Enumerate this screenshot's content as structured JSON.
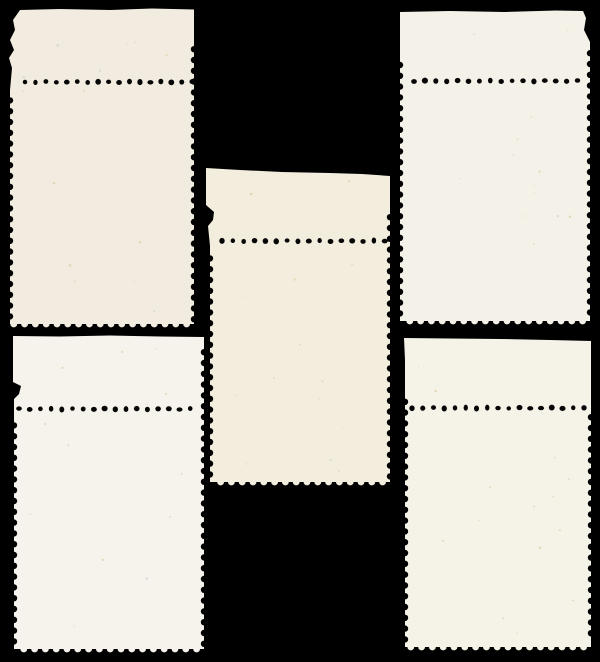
{
  "scene": {
    "description": "Scan of five mint postage stamps shown from the back, each with a blank top selvage tab, arranged on a black background",
    "width": 600,
    "height": 662,
    "background_color": "#000000"
  },
  "perforation": {
    "side_notch_radius": 3.2,
    "notch_period": 10.8,
    "tooth_radius": 3.4,
    "tooth_period": 10.8,
    "dot_base_radius": 2.6,
    "dot_color": "#060606"
  },
  "speck_colors": [
    "rgba(190,160,90,0.35)",
    "rgba(150,150,150,0.22)",
    "rgba(205,175,110,0.30)"
  ],
  "stamps": [
    {
      "name": "stamp-top-left",
      "color": "#f1ecdf",
      "left": 10,
      "right": 194,
      "bottom_y": 324,
      "right_perf_start": 46,
      "left_perf_start": 90,
      "top_edge_points": [
        [
          20,
          10
        ],
        [
          60,
          9
        ],
        [
          110,
          10
        ],
        [
          152,
          8.5
        ],
        [
          194,
          9.5
        ]
      ],
      "left_edge_points": [
        [
          20,
          10
        ],
        [
          13,
          20
        ],
        [
          15,
          30
        ],
        [
          10,
          40
        ],
        [
          14,
          50
        ],
        [
          9,
          58
        ],
        [
          12,
          68
        ],
        [
          10,
          90
        ]
      ],
      "dots": {
        "y": 82,
        "x1": 25,
        "spacing": 10.45,
        "count": 17
      }
    },
    {
      "name": "stamp-top-right",
      "color": "#f4f1e8",
      "left": 400,
      "right": 590,
      "bottom_y": 321,
      "right_perf_start": 50,
      "left_perf_start": 56,
      "top_edge_points": [
        [
          400,
          12
        ],
        [
          450,
          11
        ],
        [
          505,
          12
        ],
        [
          556,
          10.5
        ],
        [
          583,
          11
        ],
        [
          586,
          18
        ],
        [
          584,
          30
        ],
        [
          590,
          42
        ],
        [
          590,
          50
        ]
      ],
      "left_edge_points": [
        [
          400,
          12
        ],
        [
          400,
          56
        ]
      ],
      "dots": {
        "y": 81,
        "x1": 414,
        "spacing": 10.9,
        "count": 16
      }
    },
    {
      "name": "stamp-middle",
      "color": "#f2eddc",
      "left": 210,
      "right": 390,
      "bottom_y": 482,
      "right_perf_start": 214,
      "left_perf_start": 246,
      "top_edge_points": [
        [
          206,
          168
        ],
        [
          240,
          170
        ],
        [
          282,
          172
        ],
        [
          330,
          173
        ],
        [
          362,
          174
        ],
        [
          390,
          176
        ]
      ],
      "left_edge_points": [
        [
          206,
          168
        ],
        [
          206,
          205
        ],
        [
          214,
          212
        ],
        [
          213,
          220
        ],
        [
          208,
          226
        ],
        [
          210,
          246
        ]
      ],
      "dots": {
        "y": 241,
        "x1": 222,
        "spacing": 10.85,
        "count": 16
      }
    },
    {
      "name": "stamp-bottom-left",
      "color": "#f5f3ec",
      "left": 14,
      "right": 204,
      "bottom_y": 649,
      "right_perf_start": 349,
      "left_perf_start": 413,
      "top_edge_points": [
        [
          13,
          336
        ],
        [
          60,
          336.5
        ],
        [
          110,
          335.5
        ],
        [
          160,
          336.5
        ],
        [
          204,
          337
        ]
      ],
      "left_edge_points": [
        [
          13,
          336
        ],
        [
          13,
          382
        ],
        [
          21,
          386
        ],
        [
          19,
          394
        ],
        [
          14,
          399
        ],
        [
          14,
          413
        ]
      ],
      "dots": {
        "y": 409,
        "x1": 19,
        "spacing": 10.7,
        "count": 17
      }
    },
    {
      "name": "stamp-bottom-right",
      "color": "#f5f2e8",
      "left": 405,
      "right": 591,
      "bottom_y": 647,
      "right_perf_start": 414,
      "left_perf_start": 391,
      "top_edge_points": [
        [
          404,
          338
        ],
        [
          450,
          338.5
        ],
        [
          500,
          339
        ],
        [
          550,
          340
        ],
        [
          591,
          341
        ]
      ],
      "left_edge_points": [
        [
          404,
          338
        ],
        [
          405,
          360
        ],
        [
          405,
          391
        ]
      ],
      "dots": {
        "y": 408,
        "x1": 412,
        "spacing": 10.75,
        "count": 17
      }
    }
  ]
}
